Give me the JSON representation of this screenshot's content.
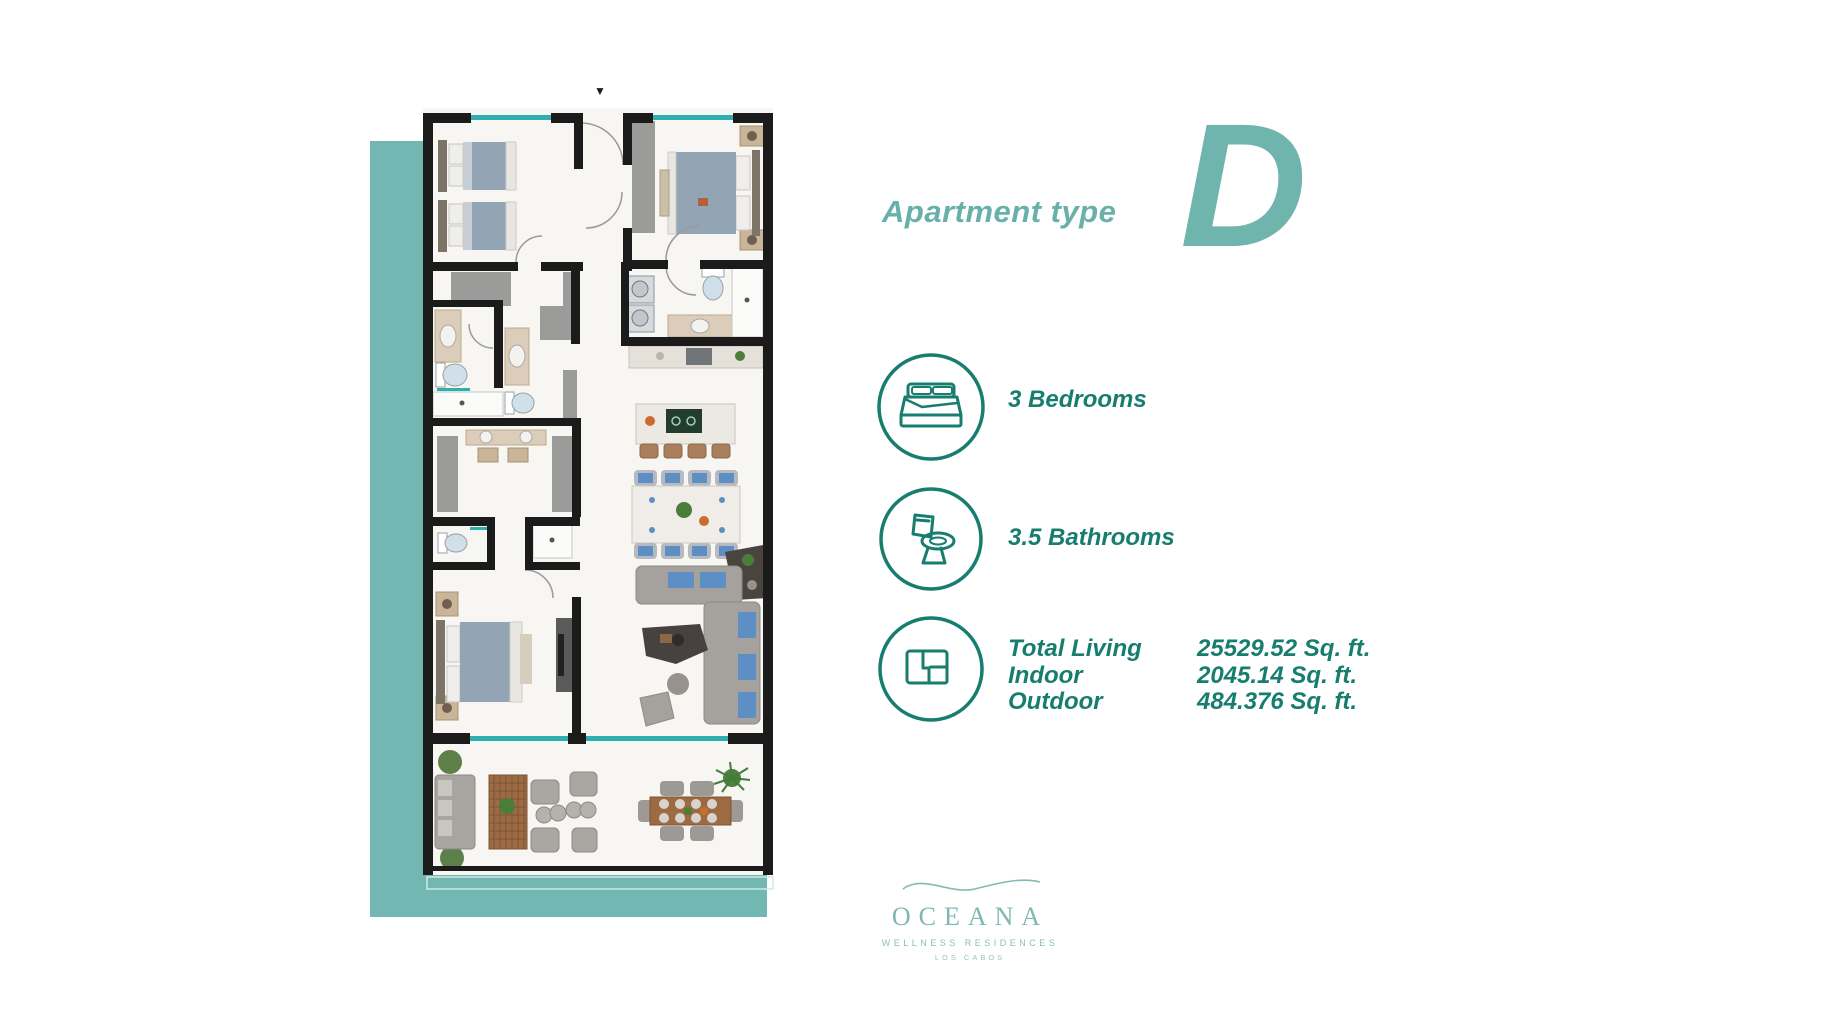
{
  "header": {
    "label": "Apartment type",
    "type_letter": "D"
  },
  "features": [
    {
      "icon": "bed-icon",
      "label": "3 Bedrooms"
    },
    {
      "icon": "toilet-icon",
      "label": "3.5 Bathrooms"
    },
    {
      "icon": "floor-plan-icon",
      "label": ""
    }
  ],
  "areas": {
    "rows": [
      {
        "label": "Total Living",
        "value": "25529.52 Sq. ft."
      },
      {
        "label": "Indoor",
        "value": "2045.14 Sq. ft."
      },
      {
        "label": "Outdoor",
        "value": "484.376 Sq. ft."
      }
    ]
  },
  "floor_plan": {
    "entry_marker": "▼"
  },
  "logo": {
    "name": "OCEANA",
    "subtitle": "WELLNESS RESIDENCES",
    "location": "LOS CABOS"
  },
  "colors": {
    "accent_teal": "#6fb5ae",
    "band_teal": "#72b7b1",
    "feature_green": "#177d6f",
    "window_teal": "#2fb0b0",
    "wall_black": "#1b1b1b",
    "logo_teal": "#7db8b4"
  }
}
